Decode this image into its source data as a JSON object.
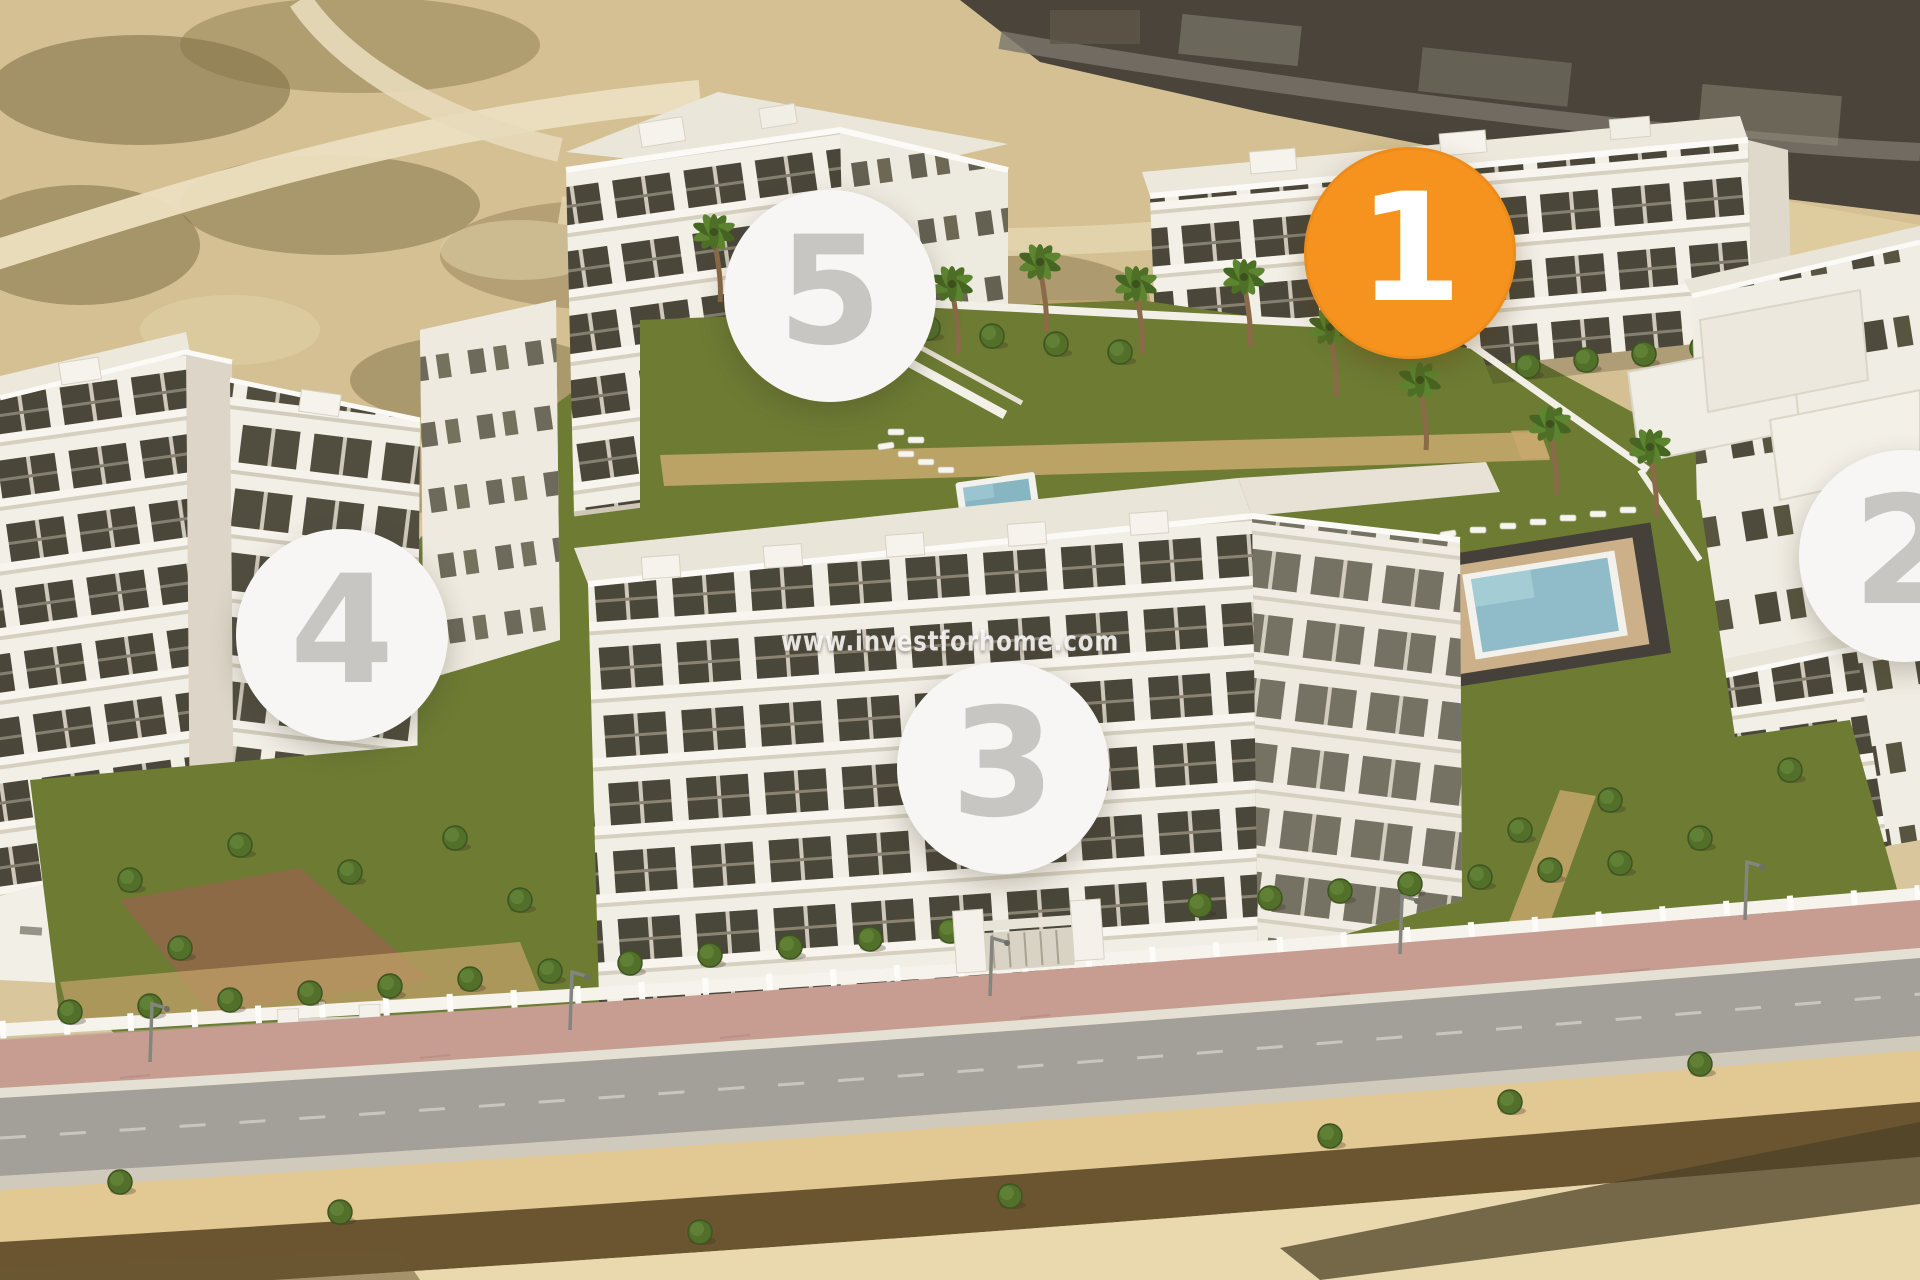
{
  "watermark": {
    "text": "www.investforhome.com"
  },
  "markers": {
    "items": [
      {
        "label": "1",
        "highlighted": true
      },
      {
        "label": "2",
        "highlighted": false
      },
      {
        "label": "3",
        "highlighted": false
      },
      {
        "label": "4",
        "highlighted": false
      },
      {
        "label": "5",
        "highlighted": false
      }
    ],
    "highlight_bg": "#F6921E",
    "highlight_fg": "#FFFFFF",
    "default_bg": "#F7F6F4",
    "default_fg": "#C8C6C2"
  },
  "palette": {
    "sand": "#D9C69C",
    "scrub_brown": "#6A5A33",
    "lawn_green": "#6D7B33",
    "pool_water": "#8FBCC8",
    "building_white": "#F2EFE8",
    "asphalt_gray": "#A3A09A",
    "paving_pink": "#C79D92"
  }
}
